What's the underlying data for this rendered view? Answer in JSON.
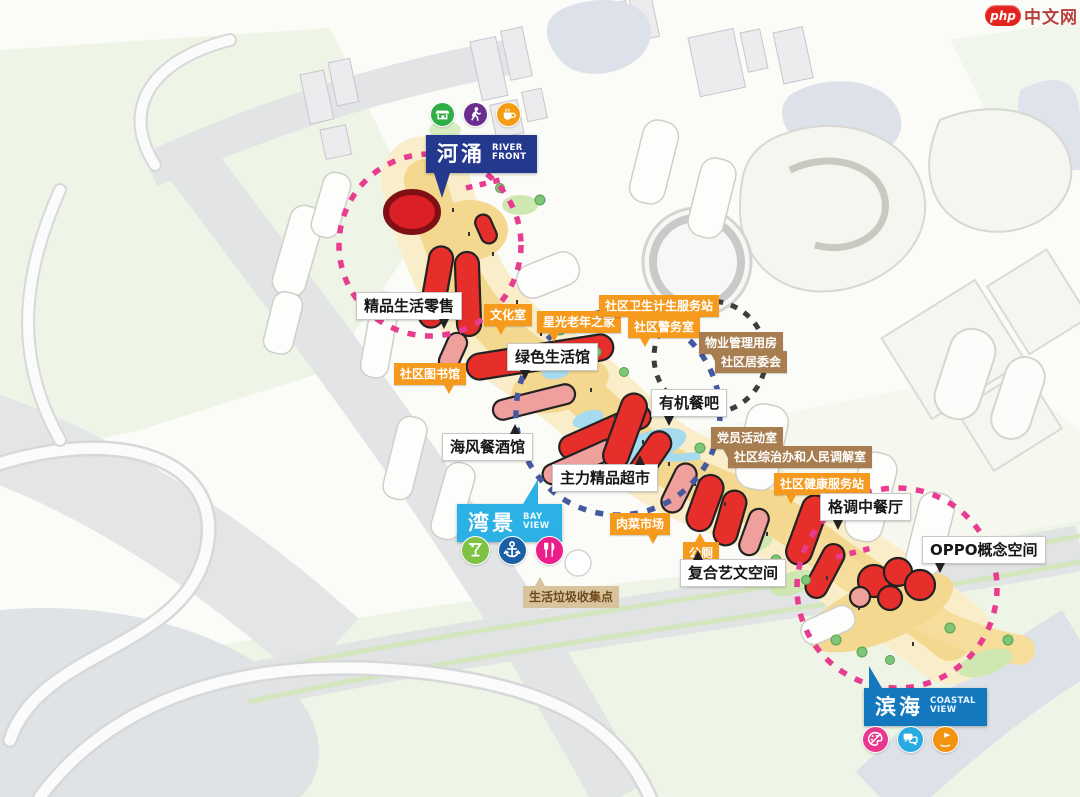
{
  "watermark": {
    "brand": "php",
    "name": "中文网"
  },
  "badges": {
    "river_front": {
      "zh": "河涌",
      "en": "RIVER FRONT"
    },
    "bay_view": {
      "zh": "湾景",
      "en": "BAY VIEW"
    },
    "coastal_view": {
      "zh": "滨海",
      "en": "COASTAL VIEW"
    }
  },
  "badge_icons": {
    "river_front": [
      "market",
      "pedestrian",
      "cafe"
    ],
    "bay_view": [
      "cocktail",
      "anchor",
      "dining"
    ],
    "coastal_view": [
      "art-palette",
      "chat",
      "leisure-flag"
    ]
  },
  "labels": {
    "retail": "精品生活零售",
    "culture_room": "文化室",
    "senior_home": "星光老年之家",
    "health_station": "社区卫生计生服务站",
    "police_room": "社区警务室",
    "property_mgmt": "物业管理用房",
    "committee": "社区居委会",
    "green_hall": "绿色生活馆",
    "library": "社区图书馆",
    "organic_bar": "有机餐吧",
    "sea_restaurant": "海风餐酒馆",
    "party_room": "党员活动室",
    "mediation": "社区综治办和人民调解室",
    "wellness": "社区健康服务站",
    "supermarket": "主力精品超市",
    "market": "肉菜市场",
    "toilet": "公厕",
    "chinese_restaurant": "格调中餐厅",
    "oppo_space": "OPPO概念空间",
    "art_space": "复合艺文空间",
    "waste_point": "生活垃圾收集点"
  },
  "colors": {
    "badge_river": "#24388e",
    "badge_bay": "#2bb1e3",
    "badge_coastal": "#1478bf",
    "label_orange": "#f59a1c",
    "label_brown": "#a87e50",
    "label_tan": "#d8c49c",
    "building_red": "#e62e2b",
    "building_pink": "#efa09d",
    "circle_pink": "#e73c90",
    "circle_blue": "#44599f",
    "circle_black": "#3d3d3d",
    "path_yellow": "#f4d88f",
    "water_blue": "#a6daee"
  }
}
